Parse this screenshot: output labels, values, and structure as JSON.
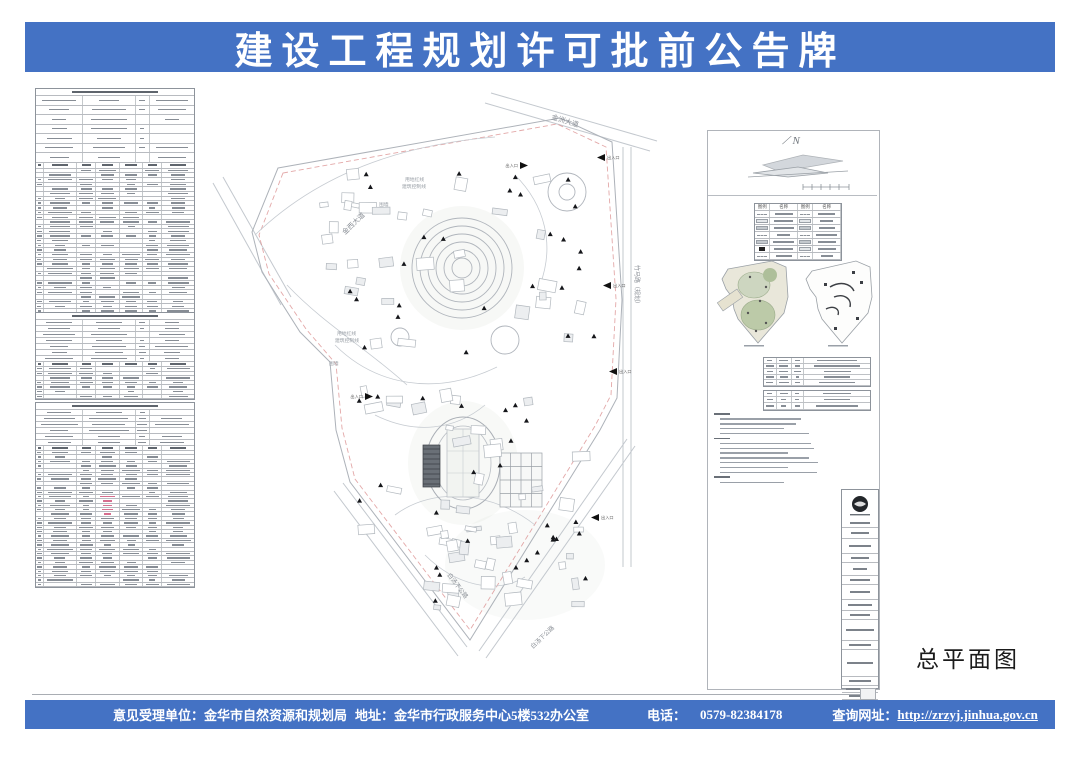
{
  "header": {
    "title": "建设工程规划许可批前公告牌"
  },
  "colors": {
    "banner_blue": "#4472c4",
    "drawing_line_gray": "#b5bac0",
    "red_line": "#d98b8b",
    "marker_black": "#111111"
  },
  "footer": {
    "agency": "意见受理单位：金华市自然资源和规划局",
    "address": "地址：金华市行政服务中心5楼532办公室",
    "phone_label": "电话：",
    "phone": "0579-82384178",
    "website_label": "查询网址：",
    "website": "http://zrzyj.jinhua.gov.cn"
  },
  "drawing": {
    "title": "总平面图",
    "north": "N",
    "roads": {
      "jinzhou": "金洲大道",
      "jinxi": "金西大道",
      "zhuma": "竹马路（规划）",
      "baitang1": "白汤下公路",
      "baitang2": "白汤下公路"
    },
    "boundary": {
      "redline": "用地红线",
      "control": "建筑控制线",
      "wall": "围墙"
    },
    "entrance": "出入口"
  },
  "legend": {
    "symbol_col": "图例",
    "name_col": "名称"
  }
}
